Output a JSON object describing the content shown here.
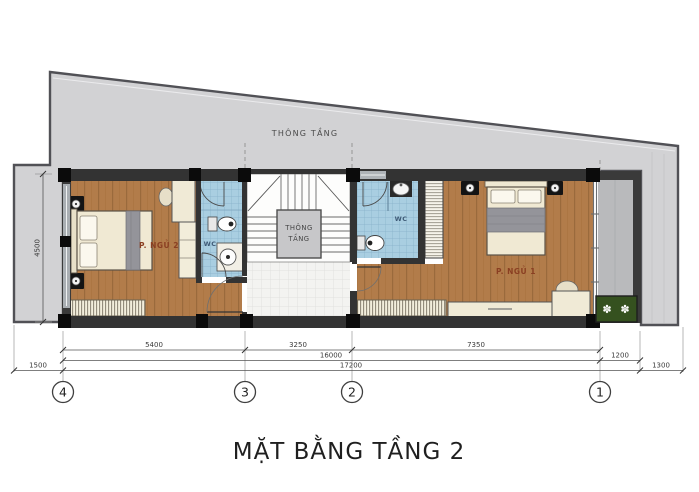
{
  "title": "MẶT BẰNG TẦNG 2",
  "plan": {
    "void_top_label": "THÔNG TẦNG",
    "stair_void": {
      "line1": "THÔNG",
      "line2": "TẦNG"
    },
    "rooms": {
      "bedroom2": {
        "name": "P. NGỦ 2"
      },
      "bedroom1": {
        "name": "P. NGỦ 1"
      },
      "wc_left": {
        "name": "WC"
      },
      "wc_right": {
        "name": "WC"
      }
    }
  },
  "dimensions": {
    "top_row": [
      "5400",
      "3250",
      "7350"
    ],
    "mid_row": [
      "16000",
      "1200"
    ],
    "bottom_row": [
      "1500",
      "17200",
      "1300"
    ],
    "left_vertical": "4500"
  },
  "grid_axes": [
    "4",
    "3",
    "2",
    "1"
  ],
  "icons": {
    "flower": "✽"
  },
  "colors": {
    "land_gray": "#d2d2d4",
    "wood_floor": "#b27c4a",
    "tile_blue": "#a9cee1",
    "tile_white": "#f3f3f1",
    "wall_dark": "#333333",
    "planter_green": "#35511f",
    "room_label": "#8a3f22",
    "wc_label": "#3e5a76"
  }
}
